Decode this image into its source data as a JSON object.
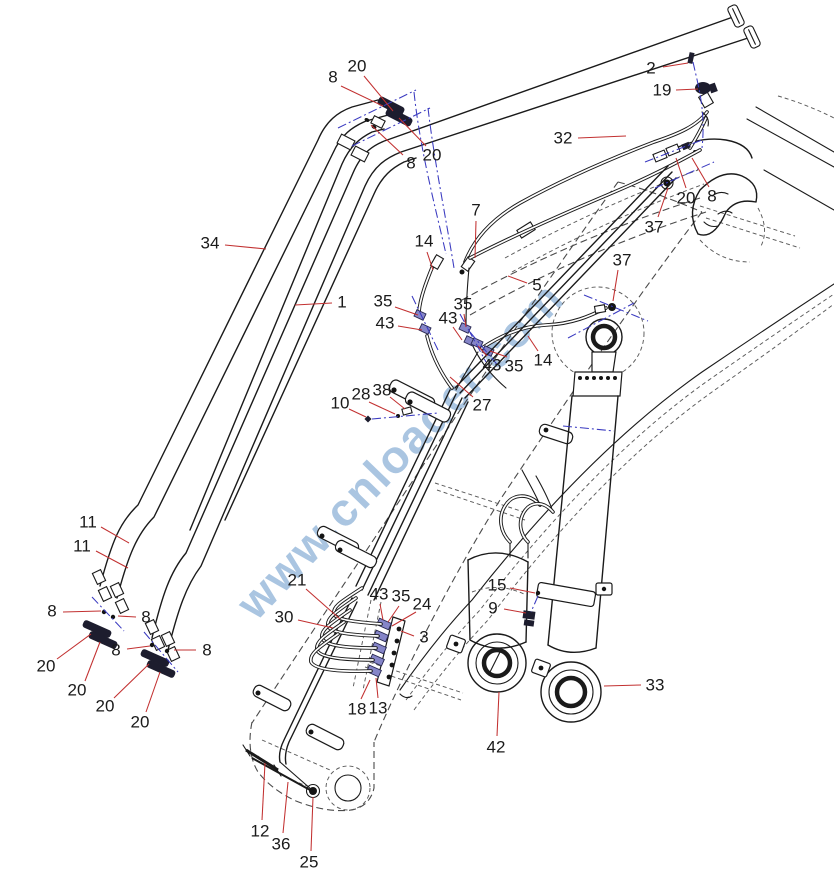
{
  "figure": {
    "type": "exploded-parts-diagram",
    "watermark": {
      "text": "www.cnloader.com",
      "color": "#9cbcdc",
      "font_size": 46,
      "rotation_deg": -46,
      "cx": 400,
      "cy": 450
    },
    "colors": {
      "background": "#ffffff",
      "linework": "#1a1a1a",
      "hidden_lines": "#4a4a4a",
      "leader_lines": "#c23030",
      "centerlines": "#3a3ac0"
    }
  },
  "labels": [
    {
      "text": "8",
      "x": 333,
      "y": 77,
      "leader": [
        341,
        86,
        383,
        106
      ]
    },
    {
      "text": "20",
      "x": 357,
      "y": 66,
      "leader": [
        364,
        76,
        393,
        111
      ]
    },
    {
      "text": "20",
      "x": 432,
      "y": 155,
      "leader": [
        426,
        146,
        399,
        118
      ]
    },
    {
      "text": "8",
      "x": 411,
      "y": 163,
      "leader": [
        403,
        155,
        371,
        125
      ]
    },
    {
      "text": "2",
      "x": 651,
      "y": 68,
      "leader": [
        663,
        67,
        688,
        63
      ]
    },
    {
      "text": "19",
      "x": 662,
      "y": 90,
      "leader": [
        676,
        90,
        698,
        89
      ]
    },
    {
      "text": "32",
      "x": 563,
      "y": 138,
      "leader": [
        578,
        138,
        626,
        136
      ]
    },
    {
      "text": "34",
      "x": 210,
      "y": 243,
      "leader": [
        225,
        245,
        266,
        249
      ]
    },
    {
      "text": "1",
      "x": 342,
      "y": 302,
      "leader": [
        332,
        303,
        295,
        305
      ]
    },
    {
      "text": "7",
      "x": 476,
      "y": 210,
      "leader": [
        476,
        221,
        475,
        258
      ]
    },
    {
      "text": "14",
      "x": 424,
      "y": 241,
      "leader": [
        427,
        252,
        433,
        270
      ]
    },
    {
      "text": "5",
      "x": 537,
      "y": 285,
      "leader": [
        527,
        283,
        508,
        276
      ]
    },
    {
      "text": "37",
      "x": 654,
      "y": 227,
      "leader": [
        658,
        217,
        668,
        188
      ]
    },
    {
      "text": "37",
      "x": 622,
      "y": 260,
      "leader": [
        618,
        270,
        613,
        301
      ]
    },
    {
      "text": "35",
      "x": 383,
      "y": 301,
      "leader": [
        395,
        307,
        418,
        315
      ]
    },
    {
      "text": "43",
      "x": 385,
      "y": 323,
      "leader": [
        398,
        326,
        422,
        330
      ]
    },
    {
      "text": "35",
      "x": 463,
      "y": 304,
      "leader": [
        464,
        314,
        466,
        327
      ]
    },
    {
      "text": "43",
      "x": 448,
      "y": 318,
      "leader": [
        453,
        327,
        462,
        340
      ]
    },
    {
      "text": "43",
      "x": 492,
      "y": 365,
      "leader": [
        487,
        356,
        478,
        346
      ]
    },
    {
      "text": "35",
      "x": 514,
      "y": 366,
      "leader": [
        507,
        357,
        490,
        351
      ]
    },
    {
      "text": "14",
      "x": 543,
      "y": 360,
      "leader": [
        538,
        351,
        528,
        336
      ]
    },
    {
      "text": "10",
      "x": 340,
      "y": 403,
      "leader": [
        349,
        409,
        366,
        417
      ]
    },
    {
      "text": "28",
      "x": 361,
      "y": 394,
      "leader": [
        369,
        402,
        395,
        414
      ]
    },
    {
      "text": "38",
      "x": 382,
      "y": 390,
      "leader": [
        390,
        397,
        405,
        409
      ]
    },
    {
      "text": "27",
      "x": 482,
      "y": 405,
      "leader": [
        473,
        397,
        450,
        377
      ]
    },
    {
      "text": "11",
      "x": 88,
      "y": 522,
      "leader": [
        101,
        527,
        129,
        543
      ]
    },
    {
      "text": "11",
      "x": 82,
      "y": 546,
      "leader": [
        96,
        551,
        128,
        568
      ]
    },
    {
      "text": "8",
      "x": 52,
      "y": 611,
      "leader": [
        63,
        612,
        101,
        611
      ]
    },
    {
      "text": "8",
      "x": 146,
      "y": 617,
      "leader": [
        136,
        617,
        118,
        616
      ]
    },
    {
      "text": "20",
      "x": 46,
      "y": 666,
      "leader": [
        57,
        659,
        91,
        634
      ]
    },
    {
      "text": "20",
      "x": 77,
      "y": 690,
      "leader": [
        85,
        681,
        100,
        642
      ]
    },
    {
      "text": "8",
      "x": 116,
      "y": 650,
      "leader": [
        127,
        649,
        150,
        646
      ]
    },
    {
      "text": "8",
      "x": 207,
      "y": 650,
      "leader": [
        196,
        650,
        174,
        650
      ]
    },
    {
      "text": "20",
      "x": 105,
      "y": 706,
      "leader": [
        114,
        698,
        149,
        664
      ]
    },
    {
      "text": "20",
      "x": 140,
      "y": 722,
      "leader": [
        146,
        712,
        160,
        672
      ]
    },
    {
      "text": "21",
      "x": 297,
      "y": 580,
      "leader": [
        306,
        589,
        340,
        619
      ]
    },
    {
      "text": "30",
      "x": 284,
      "y": 617,
      "leader": [
        298,
        620,
        333,
        628
      ]
    },
    {
      "text": "43",
      "x": 379,
      "y": 594,
      "leader": [
        380,
        604,
        383,
        620
      ]
    },
    {
      "text": "35",
      "x": 401,
      "y": 596,
      "leader": [
        399,
        606,
        388,
        622
      ]
    },
    {
      "text": "24",
      "x": 422,
      "y": 604,
      "leader": [
        416,
        612,
        392,
        626
      ]
    },
    {
      "text": "3",
      "x": 424,
      "y": 637,
      "leader": [
        414,
        636,
        401,
        631
      ]
    },
    {
      "text": "18",
      "x": 357,
      "y": 709,
      "leader": [
        361,
        699,
        370,
        680
      ]
    },
    {
      "text": "13",
      "x": 378,
      "y": 708,
      "leader": [
        378,
        698,
        376,
        678
      ]
    },
    {
      "text": "15",
      "x": 497,
      "y": 585,
      "leader": [
        510,
        588,
        535,
        593
      ]
    },
    {
      "text": "9",
      "x": 493,
      "y": 608,
      "leader": [
        504,
        609,
        526,
        613
      ]
    },
    {
      "text": "33",
      "x": 655,
      "y": 685,
      "leader": [
        641,
        685,
        604,
        686
      ]
    },
    {
      "text": "42",
      "x": 496,
      "y": 747,
      "leader": [
        497,
        736,
        499,
        692
      ]
    },
    {
      "text": "12",
      "x": 260,
      "y": 831,
      "leader": [
        262,
        820,
        265,
        763
      ]
    },
    {
      "text": "36",
      "x": 281,
      "y": 844,
      "leader": [
        283,
        833,
        288,
        782
      ]
    },
    {
      "text": "25",
      "x": 309,
      "y": 862,
      "leader": [
        311,
        851,
        313,
        797
      ]
    },
    {
      "text": "20",
      "x": 686,
      "y": 198,
      "leader": [
        686,
        188,
        676,
        158
      ]
    },
    {
      "text": "8",
      "x": 712,
      "y": 196,
      "leader": [
        709,
        187,
        692,
        158
      ]
    }
  ]
}
